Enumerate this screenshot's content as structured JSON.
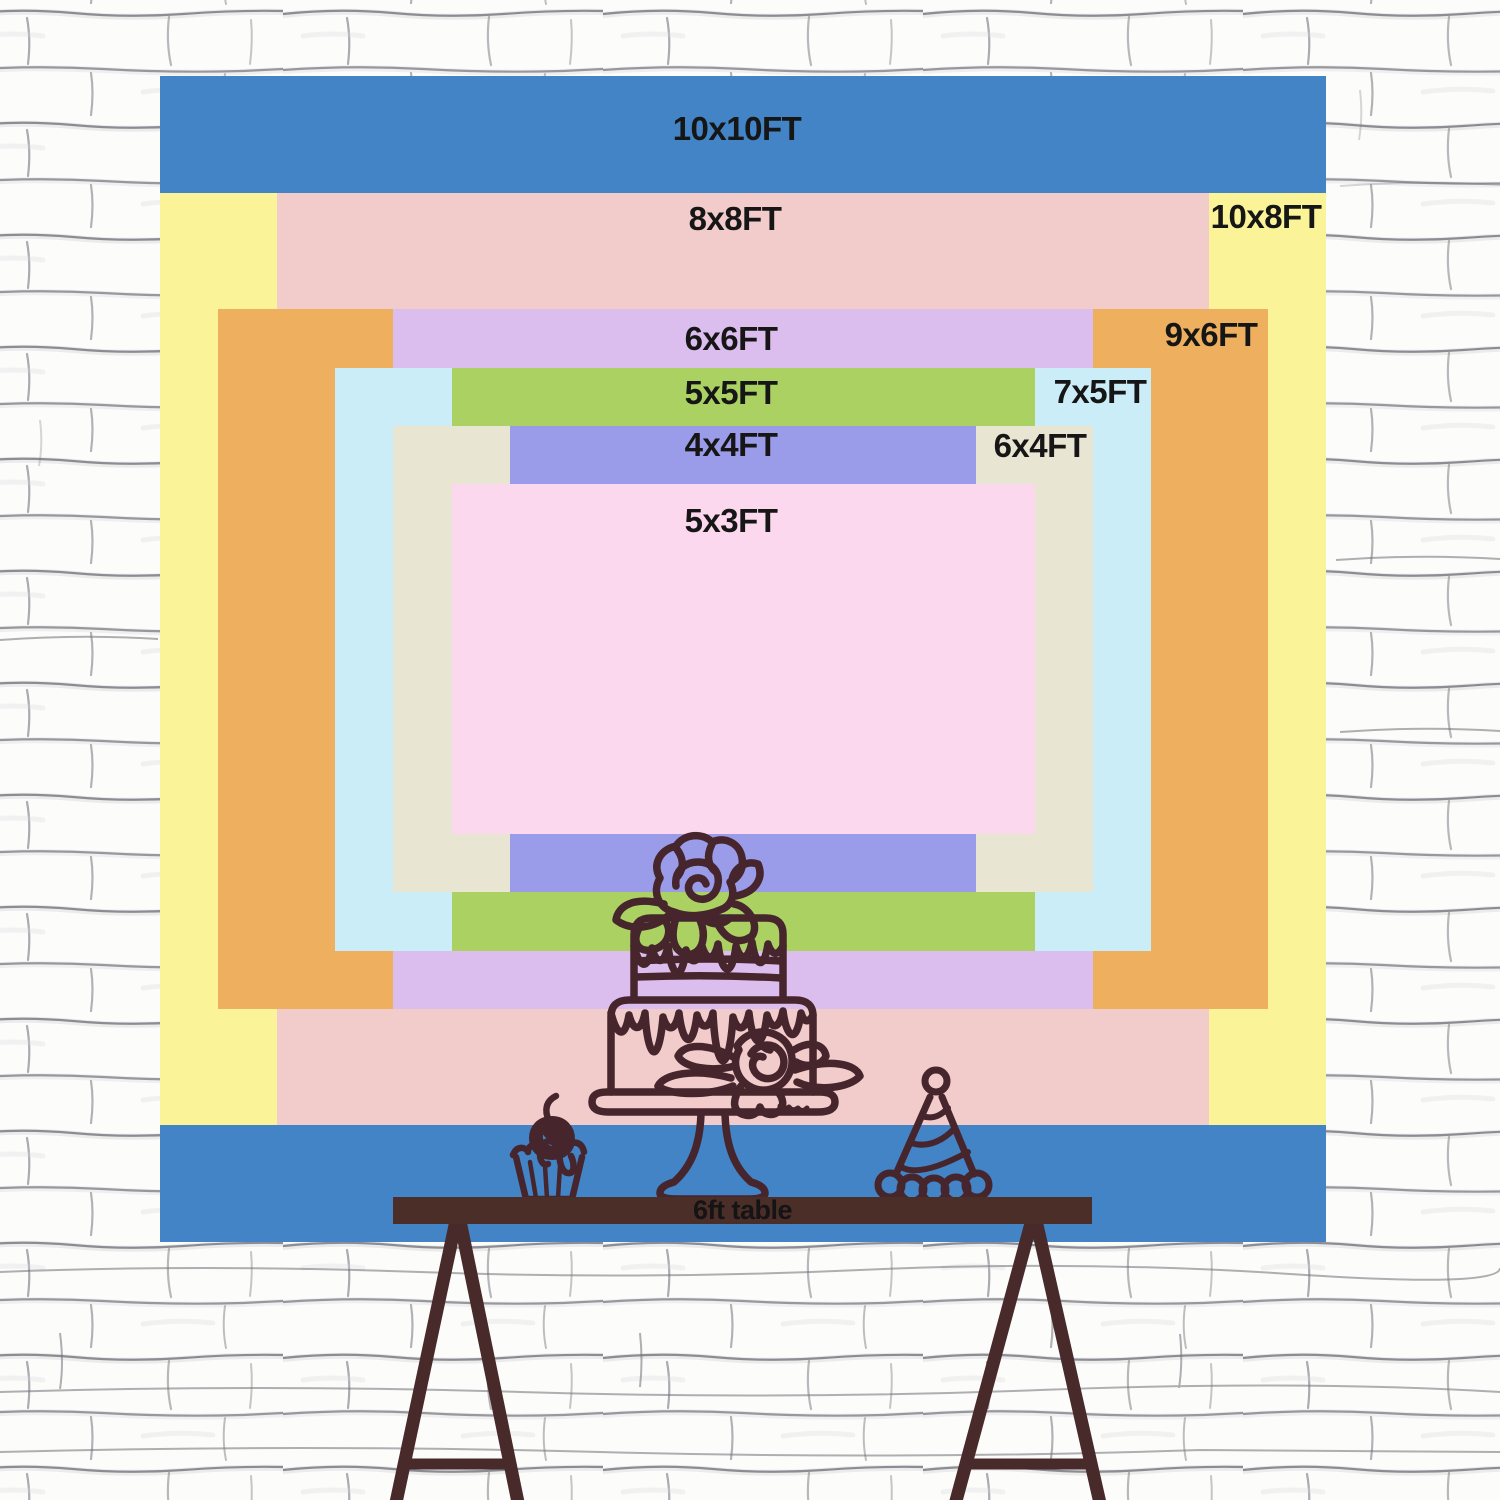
{
  "backdrop": {
    "label_color": "#161616",
    "layers": [
      {
        "id": "10x10ft",
        "label": "10x10FT",
        "width_ft": 10,
        "height_ft": 10,
        "color": "#4284c5",
        "label_pos": {
          "x": 737,
          "y": 129
        }
      },
      {
        "id": "10x8ft",
        "label": "10x8FT",
        "width_ft": 10,
        "height_ft": 8,
        "color": "#fbf398",
        "label_pos": {
          "x": 1266,
          "y": 217
        }
      },
      {
        "id": "8x8ft",
        "label": "8x8FT",
        "width_ft": 8,
        "height_ft": 8,
        "color": "#f2cbcb",
        "label_pos": {
          "x": 735,
          "y": 219
        }
      },
      {
        "id": "9x6ft",
        "label": "9x6FT",
        "width_ft": 9,
        "height_ft": 6,
        "color": "#eeb05f",
        "label_pos": {
          "x": 1211,
          "y": 335
        }
      },
      {
        "id": "6x6ft",
        "label": "6x6FT",
        "width_ft": 6,
        "height_ft": 6,
        "color": "#dbbeee",
        "label_pos": {
          "x": 731,
          "y": 339
        }
      },
      {
        "id": "7x5ft",
        "label": "7x5FT",
        "width_ft": 7,
        "height_ft": 5,
        "color": "#cbedf8",
        "label_pos": {
          "x": 1100,
          "y": 392
        }
      },
      {
        "id": "5x5ft",
        "label": "5x5FT",
        "width_ft": 5,
        "height_ft": 5,
        "color": "#aad161",
        "label_pos": {
          "x": 731,
          "y": 393
        }
      },
      {
        "id": "6x4ft",
        "label": "6x4FT",
        "width_ft": 6,
        "height_ft": 4,
        "color": "#e9e5d3",
        "label_pos": {
          "x": 1040,
          "y": 446
        }
      },
      {
        "id": "4x4ft",
        "label": "4x4FT",
        "width_ft": 4,
        "height_ft": 4,
        "color": "#9b9ce9",
        "label_pos": {
          "x": 731,
          "y": 445
        }
      },
      {
        "id": "5x3ft",
        "label": "5x3FT",
        "width_ft": 5,
        "height_ft": 3,
        "color": "#fcd8ee",
        "label_pos": {
          "x": 731,
          "y": 521
        }
      }
    ]
  },
  "table": {
    "label": "6ft table",
    "top_color": "#4c2e28",
    "label_color": "#141414"
  },
  "easel": {
    "leg_color": "#492a2b"
  },
  "illustration": {
    "stroke_color": "#46252d",
    "items": [
      "two-tier-cake-on-stand",
      "cupcake-with-cherry",
      "party-hat"
    ]
  },
  "wall": {
    "base_color": "#fcfcfa",
    "line_color": "#74747e"
  }
}
